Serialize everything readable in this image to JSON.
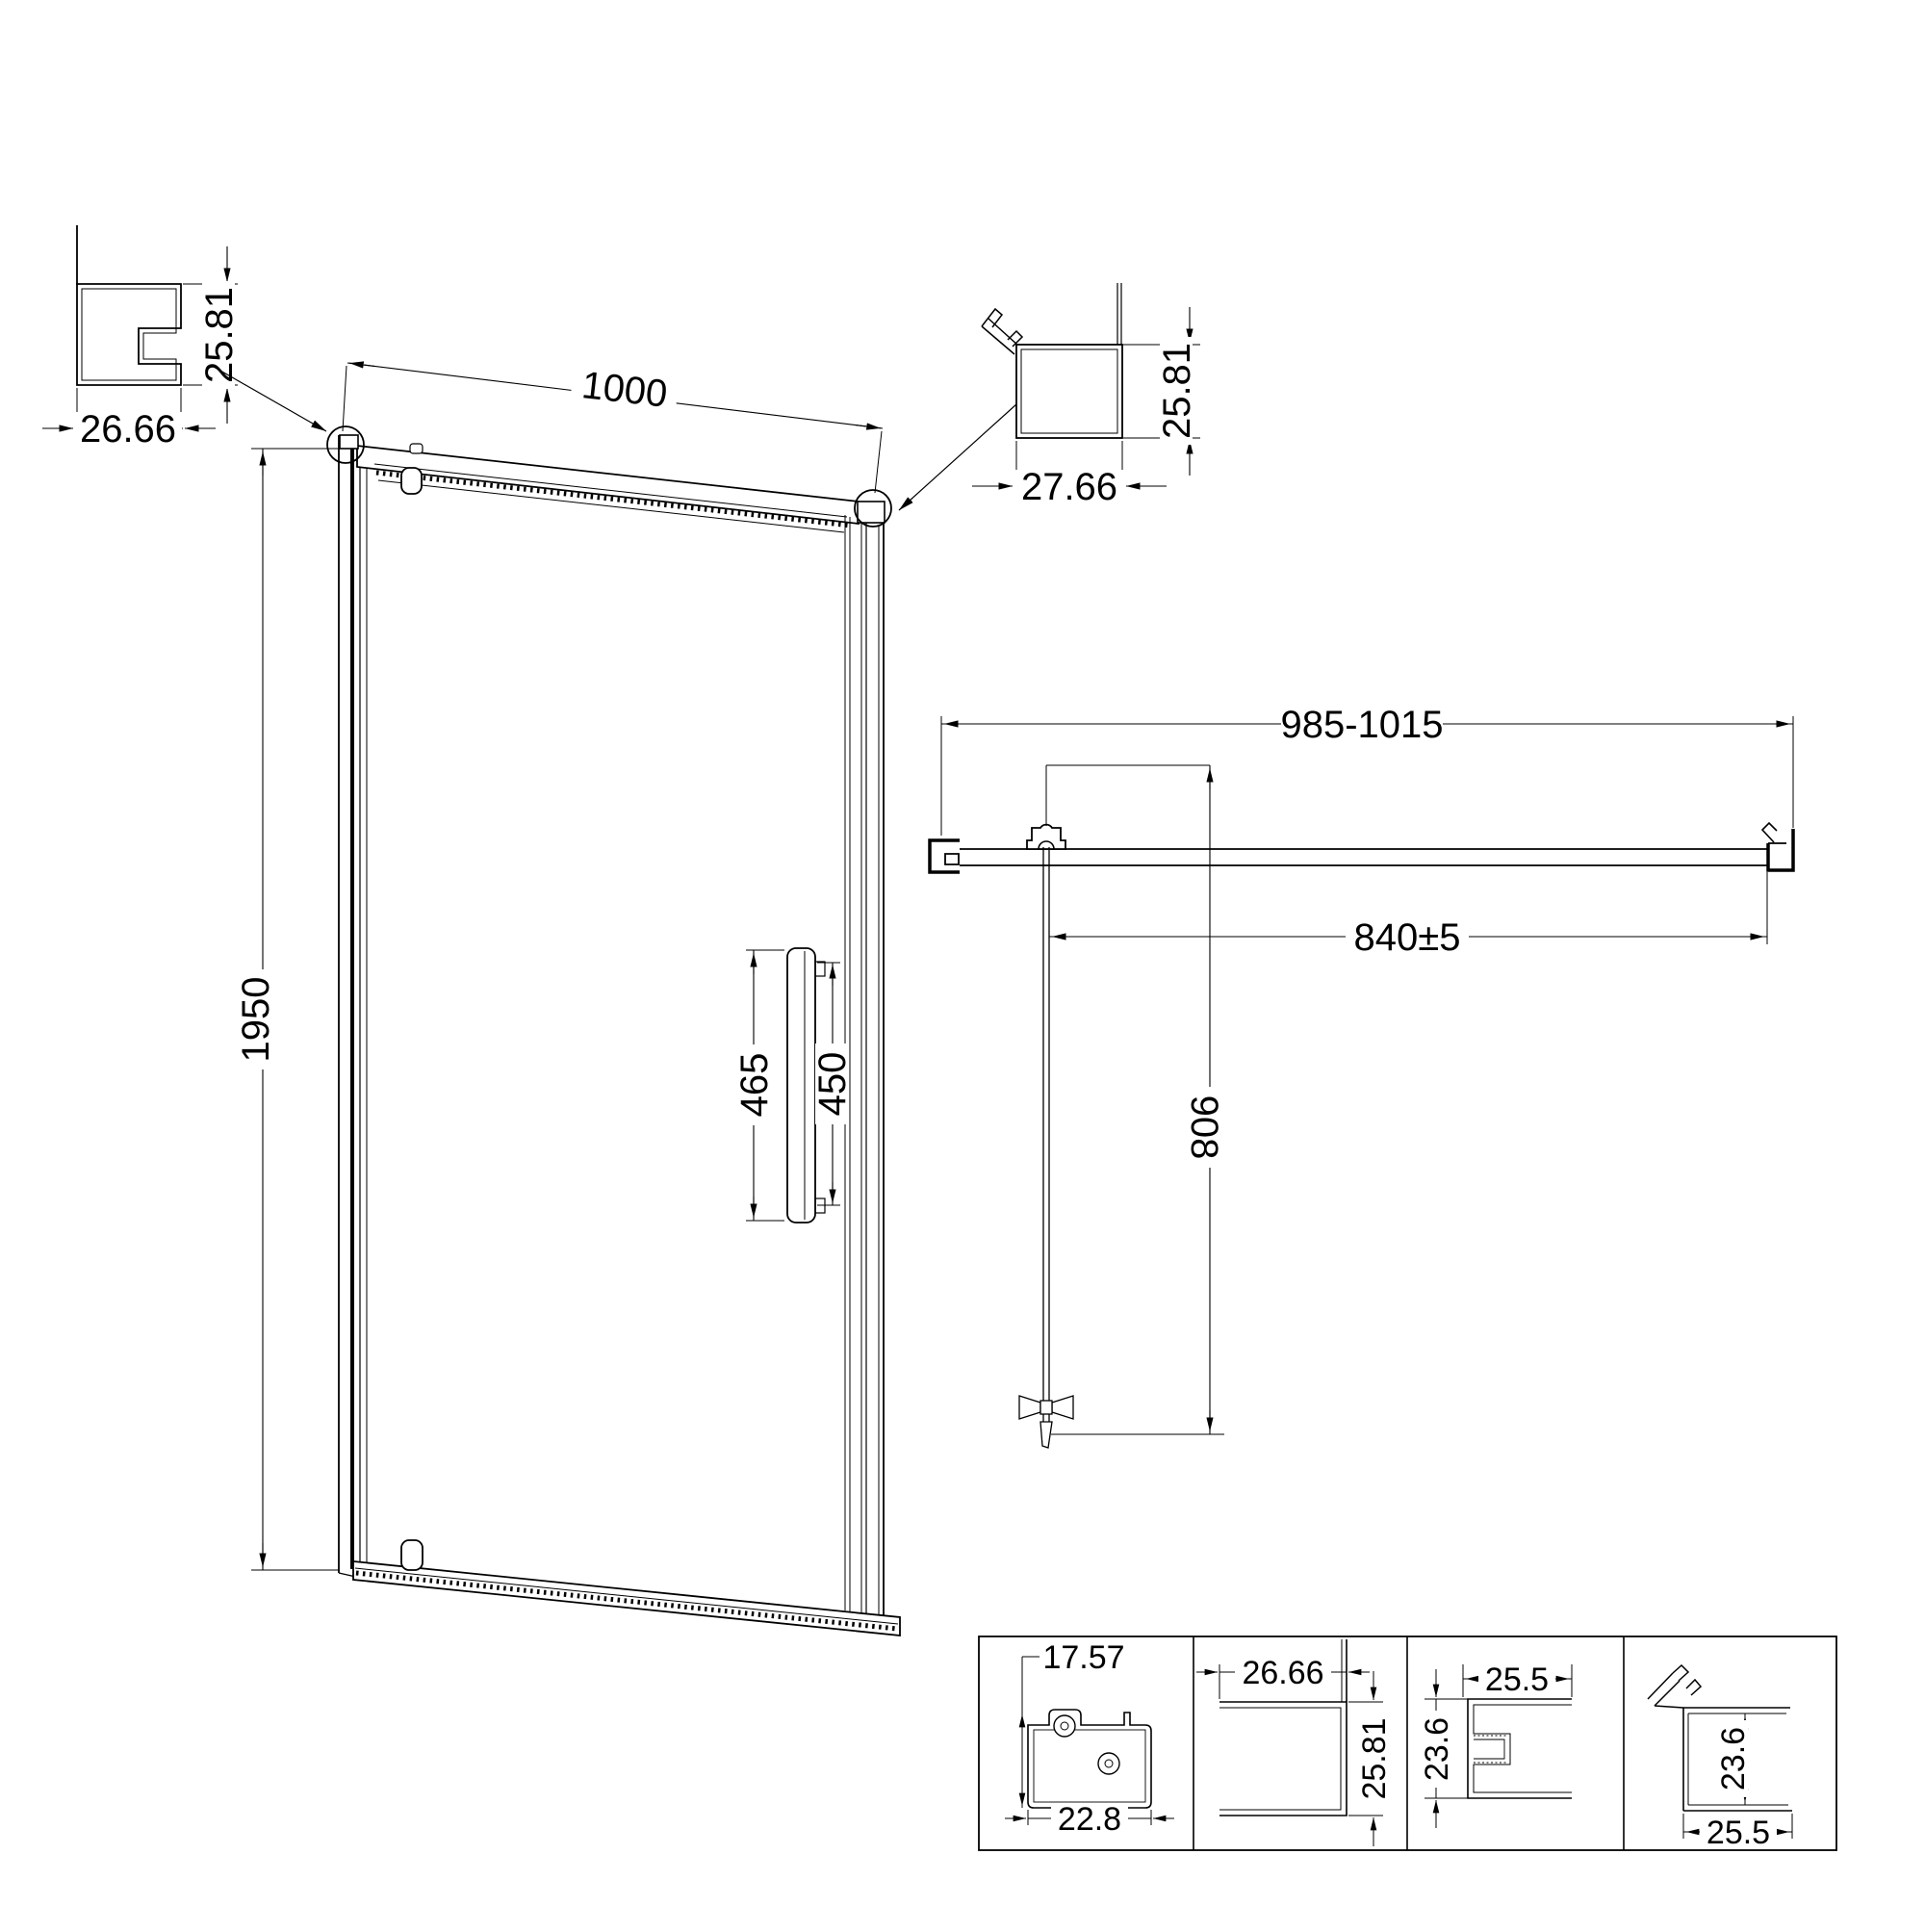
{
  "drawing": {
    "background": "#ffffff",
    "stroke_color": "#000000",
    "front_view": {
      "width": "1000",
      "height": "1950",
      "handle_outer": "465",
      "handle_inner": "450"
    },
    "wall_profile_detail": {
      "width": "26.66",
      "height": "25.81"
    },
    "strike_profile_detail": {
      "width": "27.66",
      "height": "25.81"
    },
    "plan_view": {
      "overall_width": "985-1015",
      "door_width": "840±5",
      "open_depth": "908"
    },
    "sections": {
      "rail": {
        "height": "17.57",
        "width": "22.8"
      },
      "wall": {
        "width": "26.66",
        "height": "25.81"
      },
      "channel": {
        "width": "25.5",
        "height": "23.6"
      },
      "magnet": {
        "height": "23.6",
        "width": "25.5"
      }
    }
  }
}
